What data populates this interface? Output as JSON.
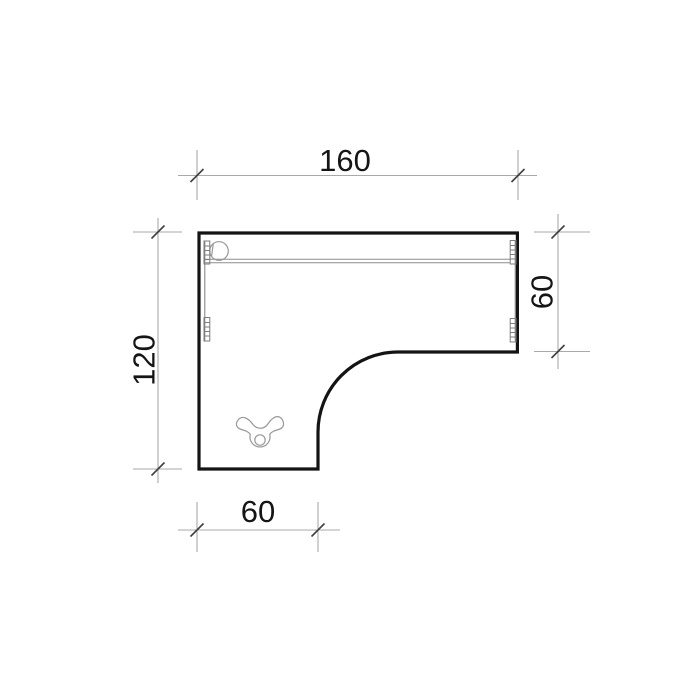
{
  "drawing": {
    "subject": "l-shaped-desk-top-view",
    "dimensions": {
      "top_width": "160",
      "right_depth": "60",
      "left_depth": "120",
      "bottom_width": "60"
    },
    "icons": {
      "grommet": "cable-grommet",
      "fitting": "leg-fitting",
      "rails": "frame-rail-with-mounting-brackets"
    },
    "colors": {
      "background": "#ffffff",
      "outline": "#141414",
      "dimension_line": "#a9a9a9",
      "tick": "#3f3f3f",
      "detail_line": "#989898",
      "text": "#151515"
    }
  }
}
